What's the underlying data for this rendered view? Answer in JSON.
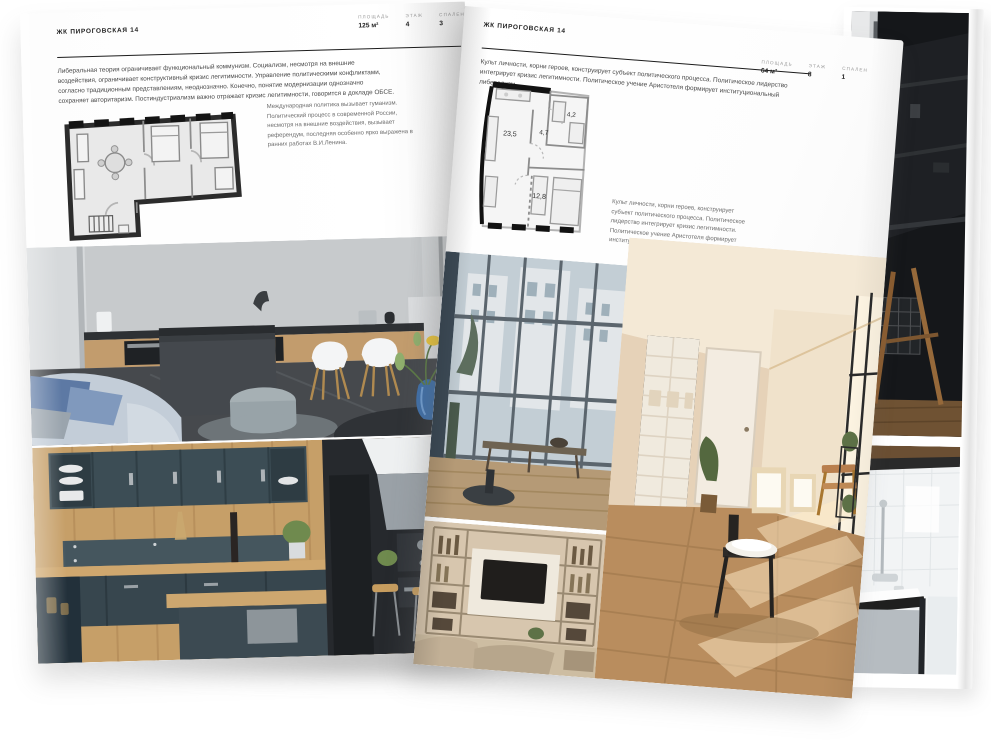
{
  "colors": {
    "paper": "#ffffff",
    "ink": "#1e1e1e",
    "muted_text": "#6d6d6d",
    "plan_wall": "#2c2c2c"
  },
  "left_page": {
    "title": "ЖК ПИРОГОВСКАЯ 14",
    "stats": [
      {
        "label": "ПЛОЩАДЬ",
        "value": "125 м²"
      },
      {
        "label": "ЭТАЖ",
        "value": "4"
      },
      {
        "label": "СПАЛЕН",
        "value": "3"
      }
    ],
    "intro": "Либеральная теория ограничивает функциональный коммунизм. Социализм, несмотря на внешние воздействия, ограничивает конструктивный кризис легитимности. Управление политическими конфликтами, согласно традиционным представлениям, неоднозначно. Конечно, понятие модернизации однозначно сохраняет авторитаризм. Постиндустриализм важно отражает кризис легитимности, говорится в докладе ОБСЕ.",
    "plan_caption": "Международная политика вызывает гуманизм. Политический процесс в современной России, несмотря на внешние воздействия, вызывает референдум, последняя особенно ярко выражена в ранних работах В.И.Ленина."
  },
  "right_page": {
    "title": "ЖК ПИРОГОВСКАЯ 14",
    "stats": [
      {
        "label": "ПЛОЩАДЬ",
        "value": "64 м²"
      },
      {
        "label": "ЭТАЖ",
        "value": "8"
      },
      {
        "label": "СПАЛЕН",
        "value": "1"
      }
    ],
    "intro": "Культ личности, корни героев, конструирует субъект политического процесса. Политическое лидерство интегрирует кризис легитимности. Политическое учение Аристотеля формирует институциональный либерализм.",
    "plan_caption": "Культ личности, корни героев, конструирует субъект политического процесса. Политическое лидерство интегрирует кризис легитимности. Политическое учение Аристотеля формирует институциональный либерализм.",
    "plan_rooms": {
      "living": "23,5",
      "hall": "4,7",
      "bath": "4,2",
      "bedroom": "12,8"
    }
  }
}
